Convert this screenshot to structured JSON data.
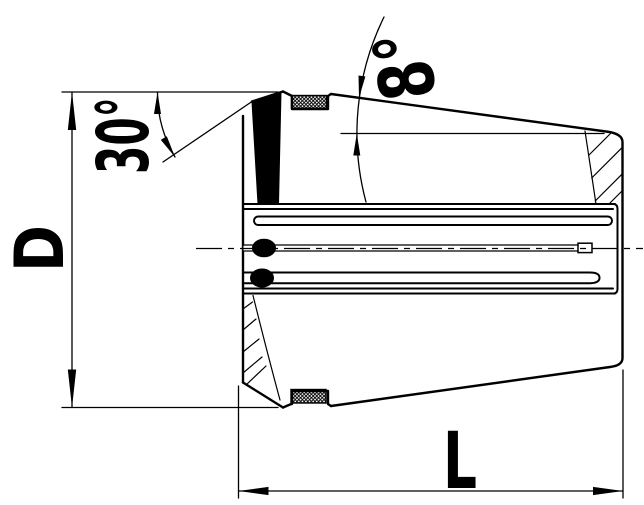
{
  "page": {
    "background_color": "#ffffff",
    "line_color": "#000000"
  },
  "drawing": {
    "labels": {
      "front_chamfer_angle": "30°",
      "cone_taper_angle": "8°",
      "outer_diameter": "D",
      "overall_length": "L"
    }
  }
}
